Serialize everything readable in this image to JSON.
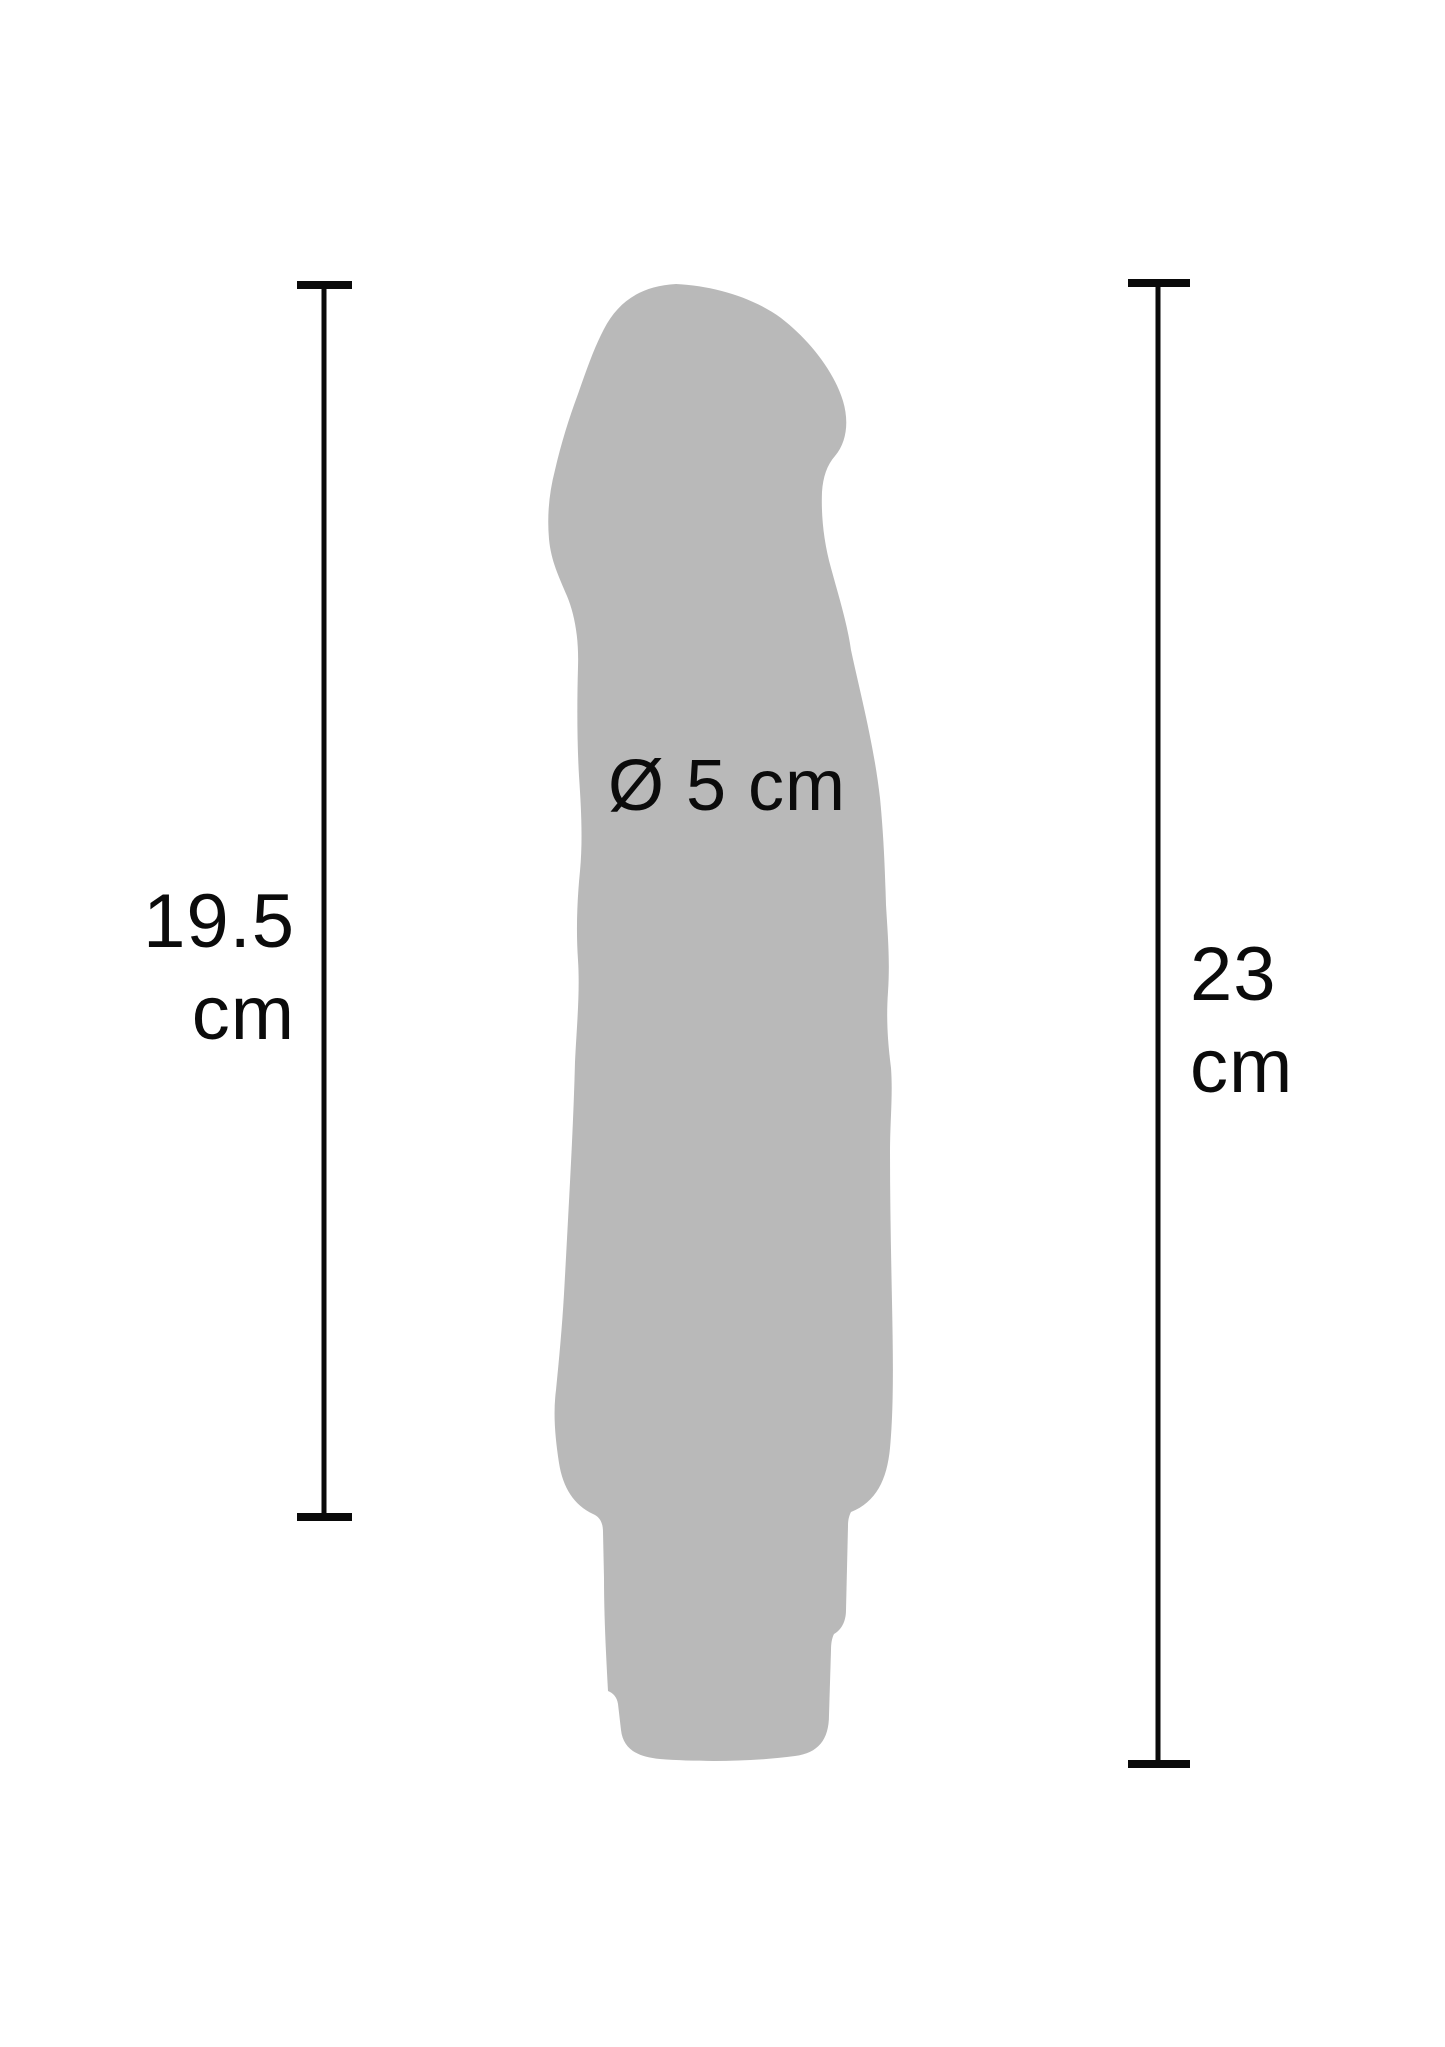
{
  "figure": {
    "type": "product-dimension-diagram",
    "background_color": "#ffffff",
    "silhouette_color": "#b9b9b9",
    "line_color": "#0a0a0a",
    "text_color": "#0b0b0b"
  },
  "measurements": {
    "left": {
      "value": "19.5",
      "unit": "cm",
      "label": "19.5 cm"
    },
    "right": {
      "value": "23",
      "unit": "cm",
      "label": "23 cm"
    },
    "diameter": {
      "label": "Ø 5 cm",
      "symbol": "Ø",
      "value": "5",
      "unit": "cm"
    }
  }
}
